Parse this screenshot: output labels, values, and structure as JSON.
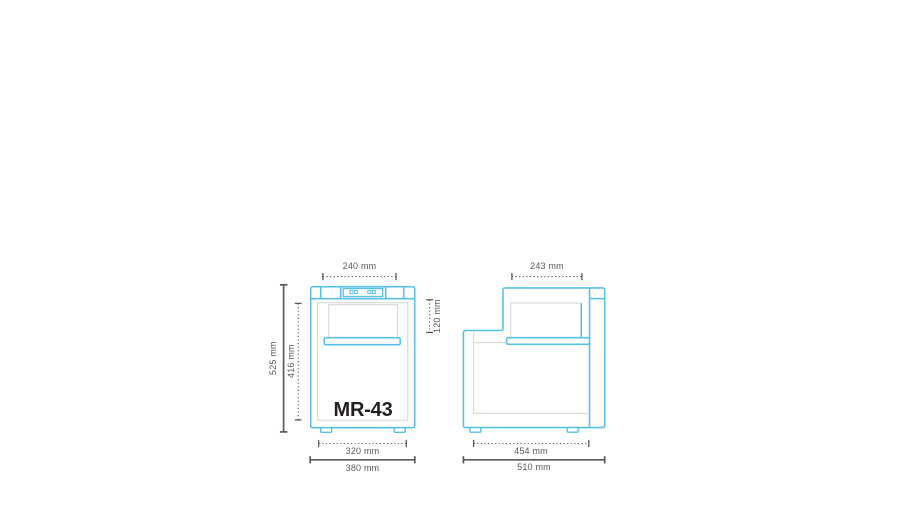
{
  "colors": {
    "background": "#FFFFFF",
    "outline_blue": "#56C2E9",
    "detail_gray": "#DADADA",
    "dimension_gray": "#58595B",
    "model_text": "#231F20"
  },
  "model_label": "MR-43",
  "front_view": {
    "dims": {
      "top_width": "240 mm",
      "overall_height": "525 mm",
      "inner_height": "416 mm",
      "lid_height": "120 mm",
      "feet_spacing": "320 mm",
      "overall_width": "380 mm"
    }
  },
  "side_view": {
    "dims": {
      "top_depth": "243 mm",
      "feet_spacing": "454 mm",
      "overall_depth": "510 mm"
    }
  }
}
